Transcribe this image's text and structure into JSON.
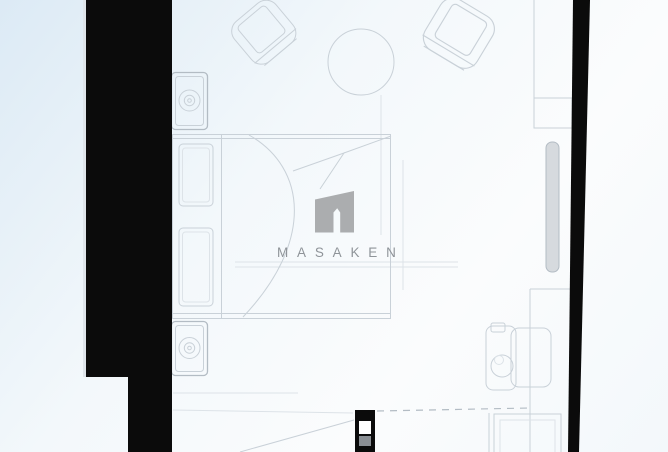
{
  "watermark": {
    "brand": "MASAKEN",
    "logo_icon": "masaken-house-logo"
  },
  "colors": {
    "background_top": "#dceaf5",
    "background_mid": "#f3f8fb",
    "background_bottom": "#fbfcfd",
    "wall": "#0b0b0b",
    "furniture_line": "#c9d1d8",
    "furniture_line_strong": "#b3bcc4",
    "furniture_line_faint": "#dde3e8",
    "door_leaf_gray": "#d6dade",
    "jamb_slot_gray": "#8a8f94",
    "watermark_gray": "#a4a6a8",
    "wordmark_gray": "#8f9499"
  },
  "floorplan": {
    "type": "studio-apartment-floor-plan",
    "elements": [
      "left-wall",
      "right-wall",
      "armchair-top-left",
      "armchair-top-right",
      "round-table",
      "bed",
      "pillow",
      "pillow",
      "nightstand-top",
      "nightstand-bottom",
      "wardrobe-shelves",
      "sliding-door-leaf",
      "bathroom-partition",
      "toilet",
      "bathroom-fixture",
      "shower-tray",
      "door-jamb",
      "door-swing-line",
      "threshold-dashed-line"
    ]
  }
}
